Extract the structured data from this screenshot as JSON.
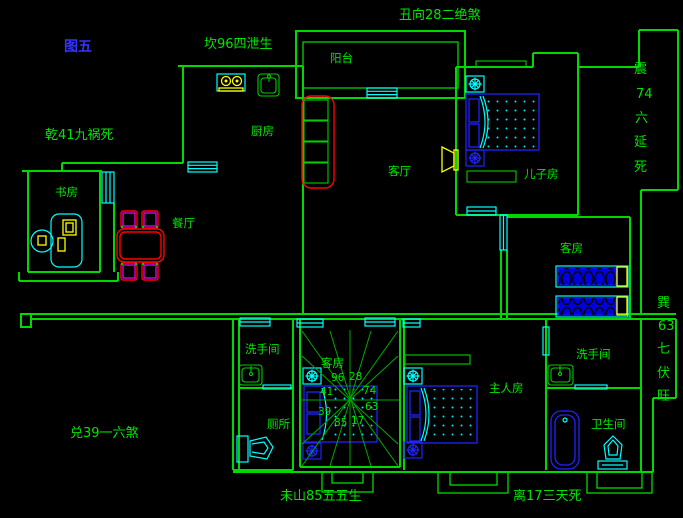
{
  "palette": {
    "background": "#000000",
    "wall_green": "#00d900",
    "text_green": "#00e400",
    "cyan": "#00ffff",
    "furniture_blue": "#2222ff",
    "deep_blue": "#0000e0",
    "red": "#ff0000",
    "magenta": "#ff00ff",
    "yellow": "#ffff00",
    "figure_blue": "#3333ff"
  },
  "figure": {
    "label": "图五"
  },
  "perimeter": {
    "north": "坎96四泄生",
    "northeast": "丑向28二绝煞",
    "northwest": "乾41九祸死",
    "west": "兑39一六煞",
    "southwest": "未山85五五生",
    "south": "离17三天死",
    "east_chars": [
      "震",
      "74",
      "六",
      "延",
      "死"
    ],
    "southeast_chars": [
      "巽",
      "63",
      "七",
      "伏",
      "旺"
    ]
  },
  "rooms": {
    "balcony": "阳台",
    "kitchen": "厨房",
    "living_room": "客厅",
    "sons_room": "儿子房",
    "guest_room_upper": "客房",
    "dining_room": "餐厅",
    "study": "书房",
    "washroom_left": "洗手间",
    "toilet": "厕所",
    "guest_room_center": "客房",
    "master_bedroom": "主人房",
    "washroom_right": "洗手间",
    "bathroom": "卫生间"
  },
  "compass": {
    "num_n1": "96",
    "num_n2": "28",
    "num_w1": "41",
    "num_e1": "74",
    "num_w2": "39",
    "num_e2": "63",
    "num_s1": "85",
    "num_s2": "17"
  },
  "icons": [
    "stove-icon",
    "kitchen-sink-icon",
    "sofa-icon",
    "tv-icon",
    "dining-table-icon",
    "chair-icon",
    "desk-icon",
    "office-chair-icon",
    "computer-icon",
    "double-bed-icon",
    "single-bed-icon",
    "nightstand-icon",
    "wardrobe-icon",
    "sink-icon",
    "toilet-icon",
    "bathtub-icon",
    "window-icon",
    "door-icon",
    "entry-step-icon",
    "compass-lines"
  ]
}
